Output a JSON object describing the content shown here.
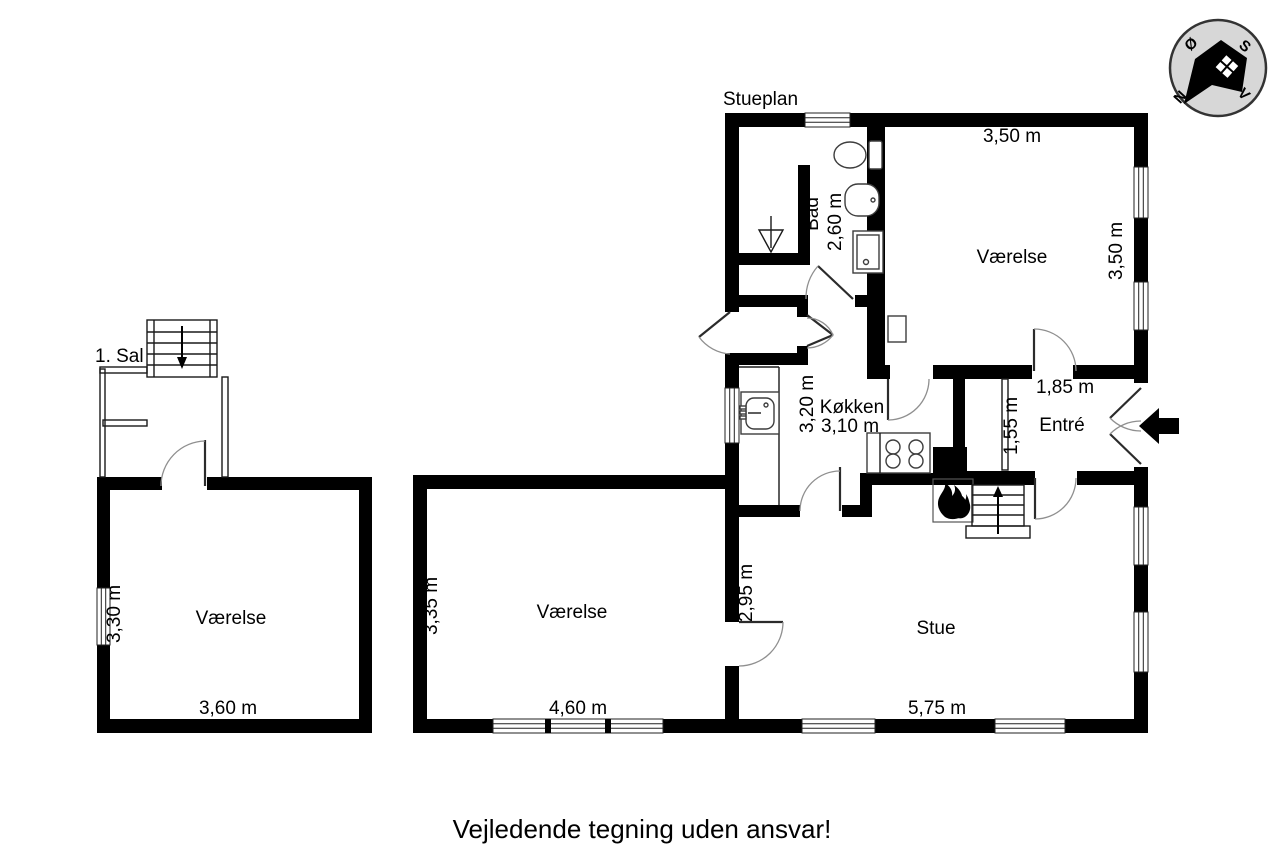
{
  "title": "Stueplan",
  "footer_note": "Vejledende tegning uden ansvar!",
  "colors": {
    "wall": "#000000",
    "background": "#ffffff",
    "compass_fill": "#d7d7d7"
  },
  "compass": {
    "north": "N",
    "south": "S",
    "east": "Ø",
    "west": "V"
  },
  "upper_floor": {
    "label": "1. Sal"
  },
  "rooms": {
    "bedroom_annex": {
      "name": "Værelse",
      "width": "3,60 m",
      "depth": "3,30 m"
    },
    "bedroom_ne": {
      "name": "Værelse",
      "width_top": "3,50 m",
      "depth_right": "3,50 m"
    },
    "bath": {
      "name": "Bad",
      "width": "2,60 m"
    },
    "kitchen": {
      "name": "Køkken",
      "depth": "3,20 m",
      "width": "3,10 m"
    },
    "entry": {
      "name": "Entré",
      "width": "1,85 m",
      "depth": "1,55 m"
    },
    "bedroom_mid": {
      "name": "Værelse",
      "depth": "3,35 m",
      "width": "4,60 m"
    },
    "living": {
      "name": "Stue",
      "width": "5,75 m",
      "partition_depth": "2,95 m"
    }
  }
}
